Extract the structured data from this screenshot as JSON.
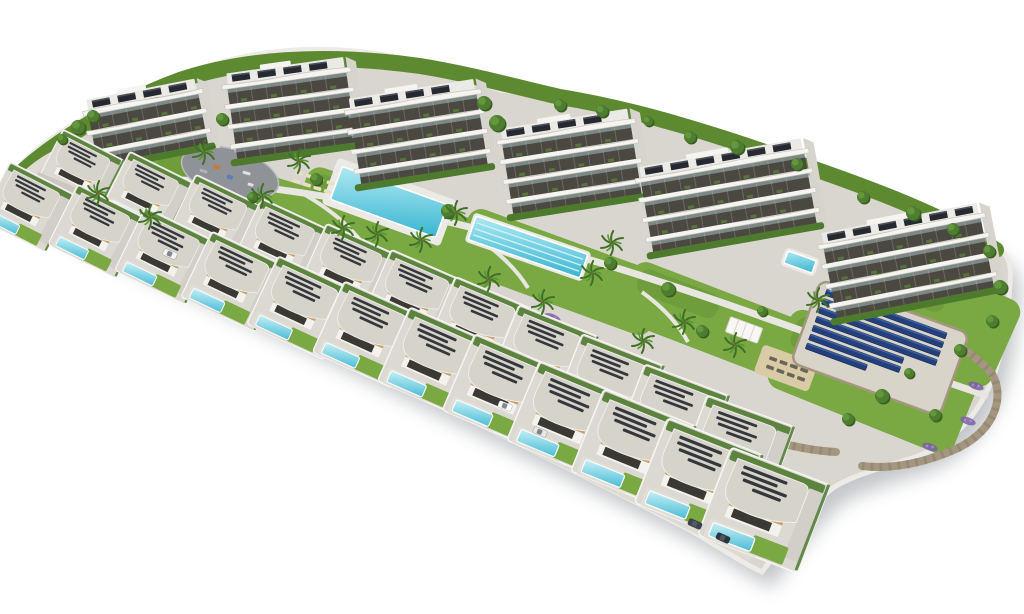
{
  "scene": {
    "canvas": {
      "width": 1024,
      "height": 614
    },
    "palette": {
      "background": "#ffffff",
      "concrete": "#d9d6d0",
      "concreteLight": "#e8e6e1",
      "rim": "#edebe7",
      "road": "#cbc8c2",
      "roadLight": "#dedbd5",
      "grass": "#7aa843",
      "grassDark": "#5d8a31",
      "shrub": "#4e7a2e",
      "treeDark": "#39601f",
      "tree": "#4e7c30",
      "treeLight": "#669a3e",
      "frond": "#3f7026",
      "frondLight": "#5a9436",
      "trunk": "#7a5c3e",
      "lavender": "#7b5ea7",
      "lavenderLight": "#a58bc9",
      "wall": "#a5977f",
      "wallDark": "#8d7f68",
      "plaza": "#8f9296",
      "buildingWhite": "#f5f4f0",
      "slabShadow": "#c8c5be",
      "facadeDark": "#4a4841",
      "mullion": "#8b887f",
      "balconyPlant": "#5a7d3b",
      "glass": "#bcd6dc",
      "roof": "#eceae6",
      "solarPanel": "#26292f",
      "solarPanelTop": "#4a4f58",
      "sideFace": "#d7d4cd",
      "villaRoof": "#d6d3cb",
      "villaWall": "#f4f2ee",
      "windowDark": "#3a3934",
      "wood": "#c8a265",
      "villaPlot": "#dcd9d2",
      "plotWall": "#f6f5f2",
      "drive": "#d2cfc8",
      "deck": "#e1ded8",
      "poolDeep": "#39b5d1",
      "poolLight": "#aee9f2",
      "laneLine": "#cdf1f7",
      "coping": "#ffffff",
      "solarField": "#24407c",
      "solarFieldStripe": "#3d5f9e",
      "solarFieldDark": "#16294f",
      "pad": "#d8d4ca",
      "sand": "#d8cba6",
      "loungerCream": "#e9dfc4",
      "loungerDark": "#6b6458",
      "shadow": "#7d838a"
    },
    "apartment_buildings": [
      {
        "id": 1,
        "x": 97,
        "y": 170,
        "w": 116,
        "floors": 3,
        "tilt": -11
      },
      {
        "id": 2,
        "x": 236,
        "y": 164,
        "w": 124,
        "floors": 4,
        "tilt": -8
      },
      {
        "id": 3,
        "x": 360,
        "y": 189,
        "w": 132,
        "floors": 4,
        "tilt": -9
      },
      {
        "id": 4,
        "x": 512,
        "y": 219,
        "w": 134,
        "floors": 4,
        "tilt": -9
      },
      {
        "id": 5,
        "x": 652,
        "y": 257,
        "w": 170,
        "floors": 4,
        "tilt": -10
      },
      {
        "id": 6,
        "x": 836,
        "y": 323,
        "w": 164,
        "floors": 4,
        "tilt": -11
      }
    ],
    "villa_rows": {
      "rowA": {
        "start": [
          80,
          172
        ],
        "control": [
          420,
          286
        ],
        "end": [
          737,
          450
        ],
        "count": 11,
        "scale": [
          0.66,
          0.9
        ],
        "rot": [
          27,
          20
        ]
      },
      "rowB": {
        "start": [
          28,
          207
        ],
        "control": [
          408,
          338
        ],
        "end": [
          764,
          510
        ],
        "count": 12,
        "scale": [
          0.7,
          1.02
        ],
        "rot": [
          27,
          21
        ]
      }
    },
    "communal_pools": [
      {
        "name": "main-pool",
        "cx": 389,
        "cy": 202,
        "len": 112,
        "wid": 35,
        "rot": 20,
        "lanes": false,
        "deck": 7
      },
      {
        "name": "lap-pool",
        "cx": 528,
        "cy": 247,
        "len": 118,
        "wid": 25,
        "rot": 19,
        "lanes": true,
        "deck": 3
      },
      {
        "name": "corner-pool",
        "cx": 800,
        "cy": 262,
        "len": 30,
        "wid": 13,
        "rot": 20,
        "lanes": false,
        "deck": 3
      }
    ],
    "plaza": {
      "cx": 230,
      "cy": 173,
      "rx": 50,
      "ry": 24,
      "rot": 16
    },
    "solar_field": {
      "cx": 880,
      "cy": 348,
      "rot": 20,
      "padW": 158,
      "padH": 88,
      "rows": [
        128,
        128,
        128,
        128,
        96,
        96,
        64
      ]
    },
    "lawns": [
      [
        238,
        196,
        190,
        58,
        17
      ],
      [
        400,
        228,
        210,
        64,
        19
      ],
      [
        560,
        272,
        210,
        66,
        20
      ],
      [
        715,
        322,
        190,
        64,
        21
      ],
      [
        872,
        382,
        200,
        84,
        22
      ],
      [
        938,
        318,
        148,
        94,
        24
      ]
    ],
    "sand_court": {
      "cx": 792,
      "cy": 370,
      "w": 74,
      "h": 28,
      "rot": 20,
      "loungers": 8
    },
    "pavilion": {
      "cx": 744,
      "cy": 330,
      "w": 34,
      "h": 16,
      "rot": 20
    },
    "palms": [
      [
        204,
        152
      ],
      [
        262,
        196
      ],
      [
        299,
        161
      ],
      [
        343,
        228
      ],
      [
        377,
        234
      ],
      [
        421,
        240
      ],
      [
        456,
        213
      ],
      [
        489,
        279
      ],
      [
        592,
        273
      ],
      [
        612,
        243
      ],
      [
        684,
        322
      ],
      [
        735,
        345
      ],
      [
        150,
        217
      ],
      [
        98,
        193
      ],
      [
        543,
        302
      ],
      [
        643,
        341
      ],
      [
        818,
        300
      ]
    ],
    "trees_back": [
      [
        78,
        127,
        7
      ],
      [
        93,
        116,
        6
      ],
      [
        62,
        139,
        5
      ],
      [
        222,
        119,
        6
      ],
      [
        484,
        103,
        7
      ],
      [
        497,
        123,
        8
      ],
      [
        560,
        105,
        6
      ],
      [
        602,
        111,
        6
      ],
      [
        648,
        121,
        5
      ],
      [
        690,
        137,
        6
      ],
      [
        737,
        147,
        7
      ],
      [
        797,
        164,
        6
      ],
      [
        863,
        197,
        6
      ],
      [
        913,
        213,
        7
      ],
      [
        953,
        229,
        6
      ],
      [
        989,
        251,
        6
      ]
    ],
    "trees_front": [
      [
        316,
        179,
        6
      ],
      [
        448,
        211,
        7
      ],
      [
        610,
        263,
        6
      ],
      [
        668,
        289,
        7
      ],
      [
        252,
        197,
        5
      ],
      [
        1000,
        287,
        7
      ],
      [
        992,
        321,
        6
      ],
      [
        882,
        396,
        7
      ],
      [
        848,
        419,
        6
      ],
      [
        909,
        373,
        5
      ],
      [
        702,
        331,
        6
      ],
      [
        762,
        311,
        5
      ],
      [
        960,
        350,
        6
      ],
      [
        935,
        415,
        6
      ]
    ],
    "flower_beds": [
      [
        222,
        235,
        9
      ],
      [
        292,
        263,
        10
      ],
      [
        366,
        296,
        10
      ],
      [
        441,
        326,
        10
      ],
      [
        516,
        356,
        10
      ],
      [
        591,
        386,
        10
      ],
      [
        661,
        413,
        9
      ],
      [
        726,
        433,
        9
      ],
      [
        858,
        301,
        8
      ],
      [
        906,
        326,
        9
      ],
      [
        946,
        353,
        8
      ],
      [
        976,
        386,
        8
      ],
      [
        968,
        421,
        8
      ],
      [
        930,
        447,
        8
      ],
      [
        196,
        191,
        7
      ],
      [
        552,
        318,
        9
      ],
      [
        624,
        366,
        8
      ]
    ],
    "lounger_clusters": [
      {
        "x": 296,
        "y": 170,
        "rot": 18,
        "count": 8,
        "tone": "cream"
      },
      {
        "x": 552,
        "y": 178,
        "rot": 19,
        "count": 6,
        "tone": "cream"
      },
      {
        "x": 770,
        "y": 356,
        "rot": 20,
        "count": 8,
        "tone": "dark"
      }
    ],
    "cars": [
      [
        170,
        254,
        22,
        "#f4f4f2"
      ],
      [
        505,
        406,
        22,
        "#ffffff"
      ],
      [
        540,
        432,
        22,
        "#e8e7e3"
      ],
      [
        695,
        524,
        24,
        "#3c4250"
      ],
      [
        723,
        538,
        24,
        "#2e3340"
      ]
    ]
  }
}
